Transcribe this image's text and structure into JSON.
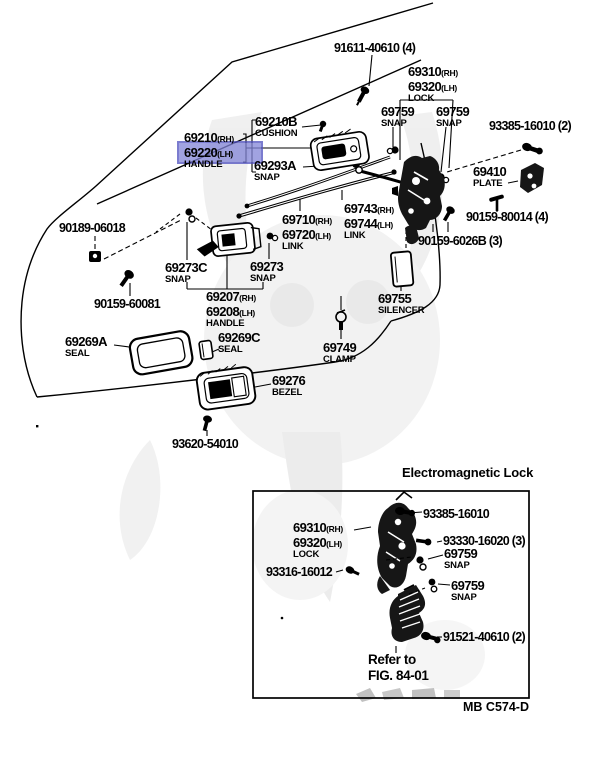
{
  "doc": {
    "footer_code": "MB C574-D",
    "inset_title": "Electromagnetic Lock",
    "refer_line1": "Refer to",
    "refer_line2": "FIG. 84-01"
  },
  "highlight": {
    "part": "69220 (LH)",
    "fill_hex": "#8285d8",
    "border_hex": "#4f51c0"
  },
  "parts": {
    "p91611": {
      "num": "91611-40610 (4)"
    },
    "lock_pair": {
      "n1": "69310",
      "s1": "(RH)",
      "n2": "69320",
      "s2": "(LH)",
      "sub": "LOCK"
    },
    "snap_69759_a": {
      "num": "69759",
      "sub": "SNAP"
    },
    "snap_69759_b": {
      "num": "69759",
      "sub": "SNAP"
    },
    "p93385_2": {
      "num": "93385-16010 (2)"
    },
    "cushion_69210b": {
      "num": "69210B",
      "sub": "CUSHION"
    },
    "handle_out": {
      "n1": "69210",
      "s1": "(RH)",
      "n2": "69220",
      "s2": "(LH)",
      "sub": "HANDLE"
    },
    "snap_69293a": {
      "num": "69293A",
      "sub": "SNAP"
    },
    "plate_69410": {
      "num": "69410",
      "sub": "PLATE"
    },
    "p90159_80014": {
      "num": "90159-80014 (4)"
    },
    "p90189_06018": {
      "num": "90189-06018"
    },
    "link_69710": {
      "n1": "69710",
      "s1": "(RH)",
      "n2": "69720",
      "s2": "(LH)",
      "sub": "LINK"
    },
    "link_69743": {
      "n1": "69743",
      "s1": "(RH)",
      "n2": "69744",
      "s2": "(LH)",
      "sub": "LINK"
    },
    "p90159_6026b": {
      "num": "90159-6026B (3)"
    },
    "snap_69273c": {
      "num": "69273C",
      "sub": "SNAP"
    },
    "snap_69273": {
      "num": "69273",
      "sub": "SNAP"
    },
    "p90159_60081": {
      "num": "90159-60081"
    },
    "handle_in": {
      "n1": "69207",
      "s1": "(RH)",
      "n2": "69208",
      "s2": "(LH)",
      "sub": "HANDLE"
    },
    "silencer_69755": {
      "num": "69755",
      "sub": "SILENCER"
    },
    "seal_69269a": {
      "num": "69269A",
      "sub": "SEAL"
    },
    "seal_69269c": {
      "num": "69269C",
      "sub": "SEAL"
    },
    "clamp_69749": {
      "num": "69749",
      "sub": "CLAMP"
    },
    "bezel_69276": {
      "num": "69276",
      "sub": "BEZEL"
    },
    "p93620_54010": {
      "num": "93620-54010"
    }
  },
  "inset": {
    "p93385": {
      "num": "93385-16010"
    },
    "lock_pair": {
      "n1": "69310",
      "s1": "(RH)",
      "n2": "69320",
      "s2": "(LH)",
      "sub": "LOCK"
    },
    "p93330": {
      "num": "93330-16020 (3)"
    },
    "snap_69759_a": {
      "num": "69759",
      "sub": "SNAP"
    },
    "p93316": {
      "num": "93316-16012"
    },
    "snap_69759_b": {
      "num": "69759",
      "sub": "SNAP"
    },
    "p91521": {
      "num": "91521-40610 (2)"
    }
  }
}
